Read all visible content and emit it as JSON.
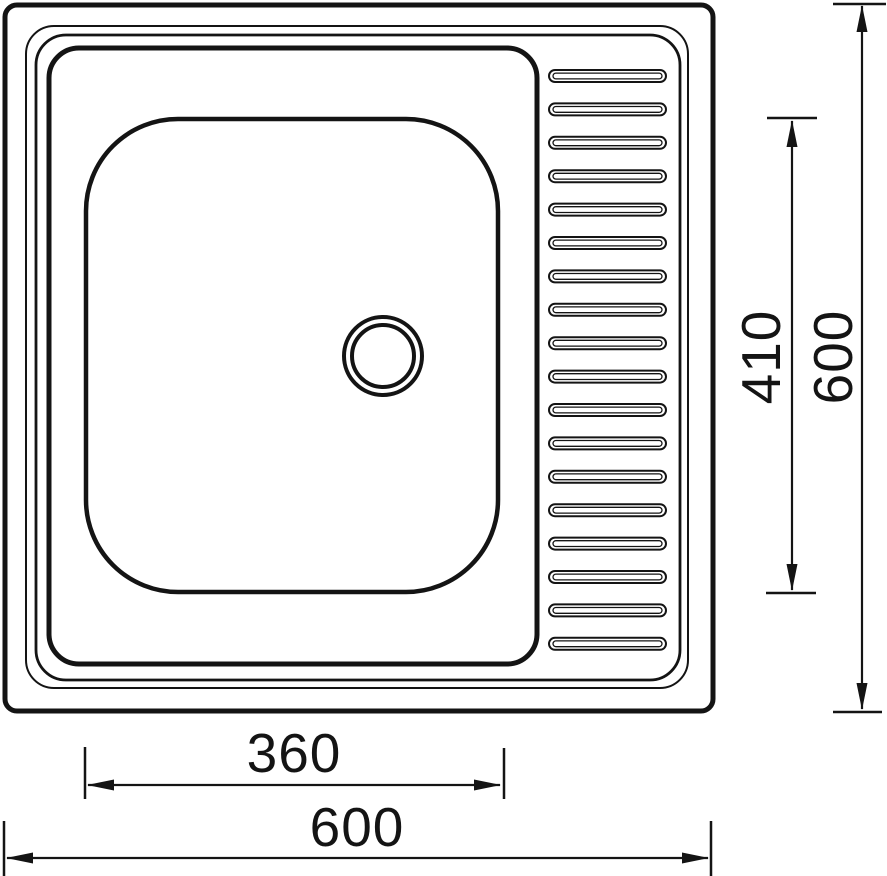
{
  "page": {
    "background_color": "#ffffff"
  },
  "drawing": {
    "subject": "single-bowl kitchen sink with right-hand ribbed drainer, top view technical drawing",
    "ink_color": "#141414",
    "dimensions": {
      "bowl_width": {
        "label": "360",
        "value": 360
      },
      "overall_width": {
        "label": "600",
        "value": 600
      },
      "bowl_height": {
        "label": "410",
        "value": 410
      },
      "overall_height": {
        "label": "600",
        "value": 600
      }
    },
    "drainer": {
      "ridge_count": 18
    },
    "drain_hole": {
      "ring_count": 2
    }
  }
}
